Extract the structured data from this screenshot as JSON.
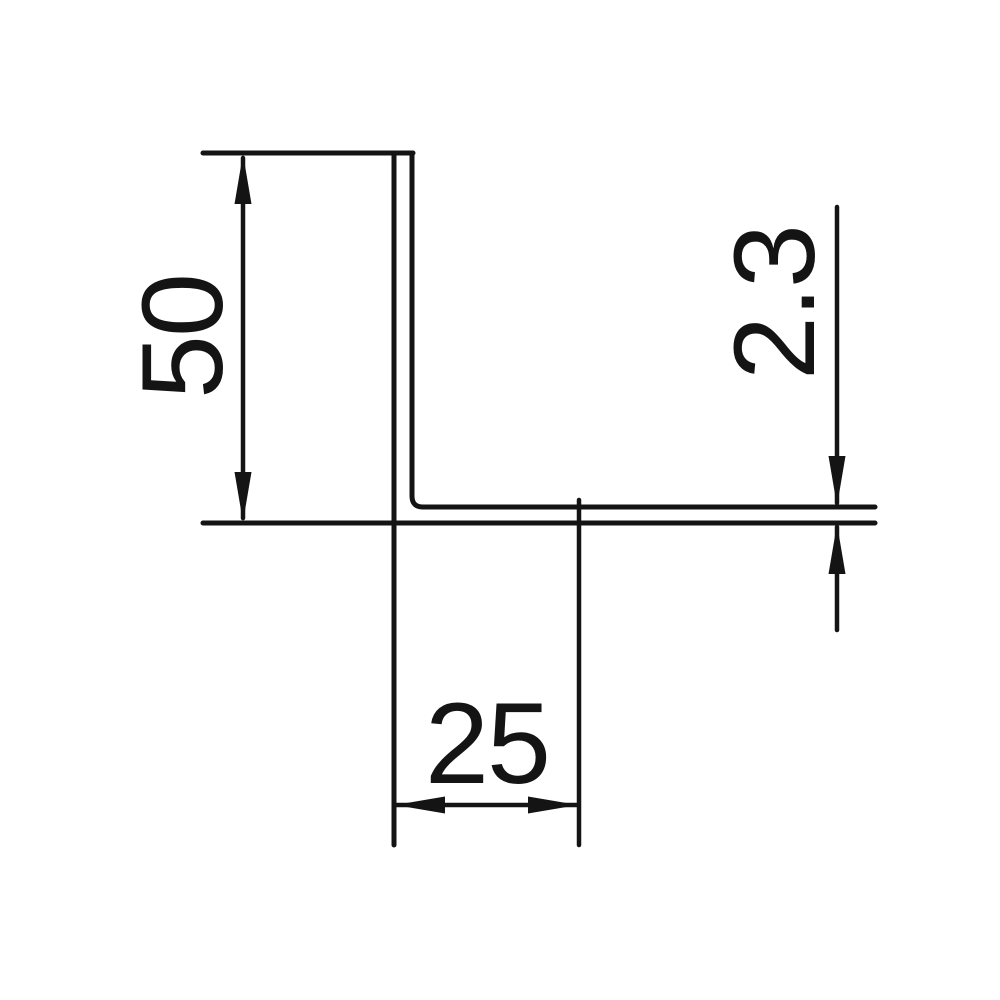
{
  "drawing": {
    "kind": "technical-drawing",
    "subject": "L-angle profile cross-section",
    "background_color": "#ffffff",
    "line_color": "#141414",
    "dimensions": {
      "leg_height": {
        "label": "50"
      },
      "flange_width": {
        "label": "25"
      },
      "wall_thickness": {
        "label": "2.3"
      }
    }
  }
}
